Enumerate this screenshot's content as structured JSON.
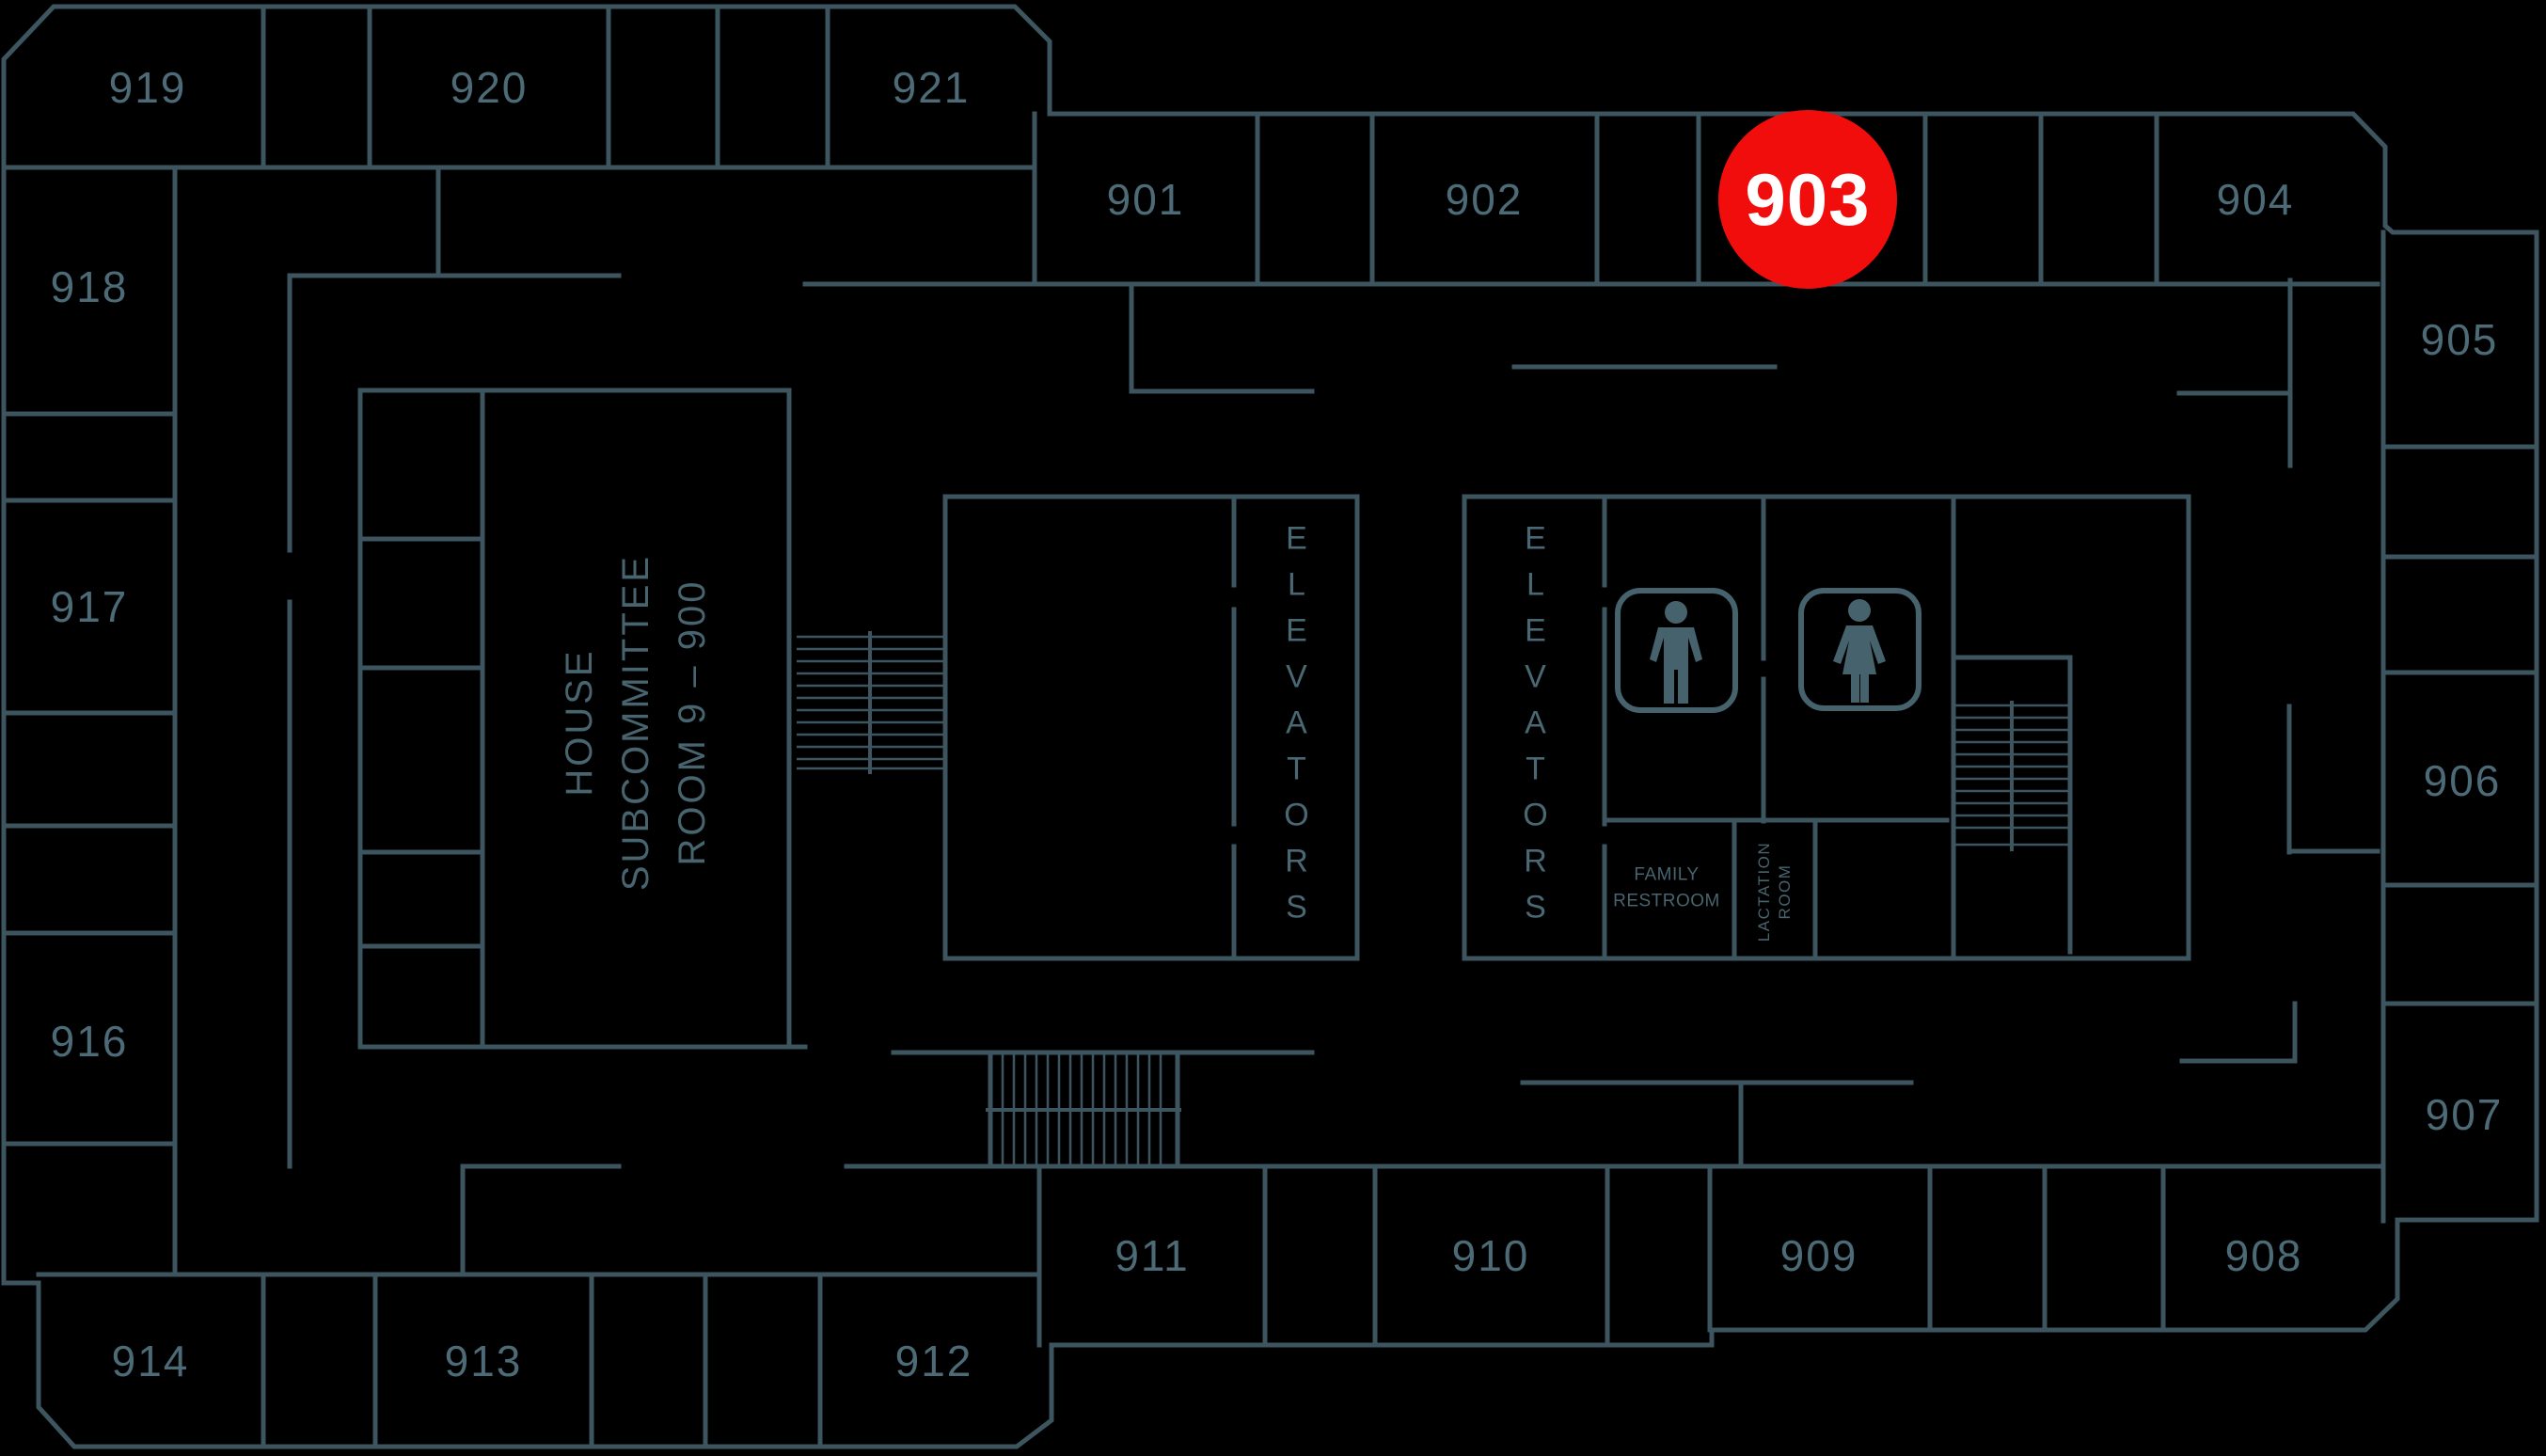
{
  "colors": {
    "background": "#000000",
    "walls": "#3d555f",
    "room_text": "#4c6b77",
    "area_text": "#47646f",
    "marker_fill": "#f20d0d",
    "marker_text": "#ffffff"
  },
  "marker": {
    "label": "903"
  },
  "rooms": {
    "r901": "901",
    "r902": "902",
    "r904": "904",
    "r905": "905",
    "r906": "906",
    "r907": "907",
    "r908": "908",
    "r909": "909",
    "r910": "910",
    "r911": "911",
    "r912": "912",
    "r913": "913",
    "r914": "914",
    "r916": "916",
    "r917": "917",
    "r918": "918",
    "r919": "919",
    "r920": "920",
    "r921": "921"
  },
  "areas": {
    "elevators_left": "ELEVATORS",
    "elevators_right": "ELEVATORS",
    "subcommittee": "HOUSE\nSUBCOMMITTEE\nROOM 9 – 900",
    "family_restroom": "FAMILY\nRESTROOM",
    "lactation_room": "LACTATION\nROOM"
  },
  "icons": {
    "male_restroom": "male-restroom-icon",
    "female_restroom": "female-restroom-icon"
  }
}
